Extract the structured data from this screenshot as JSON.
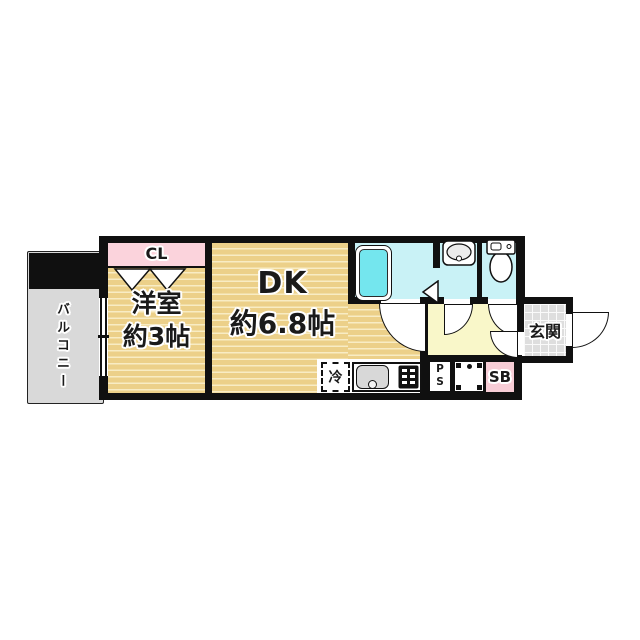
{
  "title": "1DK間取り図",
  "colors": {
    "wall": "#101010",
    "ink": "#1a1a1a",
    "floor_base": "#ecd089",
    "floor_line": "#f8ecc4",
    "closet_pink": "#fbd3dc",
    "shoebox_pink": "#f7cdd6",
    "bath_cyan": "#c9f2f6",
    "tub_cyan": "#74e6ee",
    "hall_yellow": "#f9f7c9",
    "balcony_gray": "#d9d9d9",
    "tile_gray": "#dedede"
  },
  "rooms": {
    "balcony": {
      "label": "バルコニー"
    },
    "closet": {
      "label": "CL"
    },
    "western_room": {
      "label": "洋室",
      "size": "約3帖"
    },
    "dining_kitchen": {
      "label": "DK",
      "size": "約6.8帖"
    },
    "entrance": {
      "label": "玄関"
    }
  },
  "fixtures": {
    "refrigerator": {
      "label": "冷"
    },
    "pipe_space": {
      "line1": "P",
      "line2": "S"
    },
    "shoe_box": {
      "label": "SB"
    }
  }
}
